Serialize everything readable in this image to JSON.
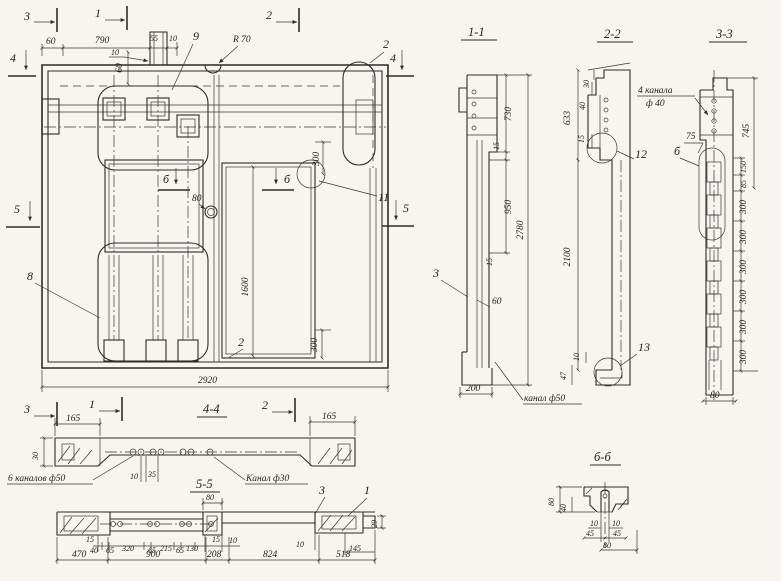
{
  "main": {
    "markers": {
      "top3": "3",
      "top1": "1",
      "top2": "2",
      "left4": "4",
      "right4": "4",
      "left5": "5",
      "right5": "5",
      "b": "б"
    },
    "dims": {
      "d60": "60",
      "d790": "790",
      "d55": "55",
      "d10": "10",
      "d10note": "10",
      "d60v": "60",
      "r70": "R 70",
      "d80": "80",
      "d300top": "300",
      "d300bot": "300",
      "d1600": "1600",
      "d2920": "2920"
    },
    "labels": {
      "l9": "9",
      "l2top": "2",
      "l11": "11",
      "l8": "8",
      "l2bot": "2"
    }
  },
  "section11": {
    "title": "1-1",
    "dims": {
      "d730": "730",
      "d15a": "15",
      "d950": "950",
      "d15b": "15",
      "d2780": "2780",
      "d60": "60",
      "d200": "200"
    },
    "label3": "3",
    "callout": "канал ф50"
  },
  "section22": {
    "title": "2-2",
    "dims": {
      "d633": "633",
      "d30": "30",
      "d40": "40",
      "d15": "15",
      "d2100": "2100",
      "d10": "10",
      "d47": "47"
    },
    "label12": "12",
    "label13": "13"
  },
  "section33": {
    "title": "3-3",
    "callout_line1": "4 канала",
    "callout_line2": "ф 40",
    "dims": {
      "d745": "745",
      "d75": "75",
      "d150": "150",
      "d85": "85",
      "d300": "300",
      "d80": "80"
    },
    "label_b": "б"
  },
  "view44": {
    "title": "4-4",
    "markers": {
      "m3": "3",
      "m1": "1",
      "m2": "2"
    },
    "dims": {
      "d165l": "165",
      "d165r": "165",
      "d30": "30",
      "d10": "10",
      "d35": "35"
    },
    "callout_left": "6 каналов ф50",
    "callout_right": "Канал ф30",
    "label3": "3",
    "label1": "1"
  },
  "view55": {
    "title": "5-5",
    "dims": {
      "d80": "80",
      "d15a": "15",
      "d40": "40",
      "d65": "65",
      "d320": "320",
      "d215": "215",
      "d130": "130",
      "d15b": "15",
      "d10a": "10",
      "d10b": "10",
      "d145": "145",
      "d29": "29",
      "d470": "470",
      "d900": "900",
      "d208": "208",
      "d824": "824",
      "d518": "518"
    }
  },
  "view66": {
    "title": "б-б",
    "dims": {
      "d80side": "80",
      "d40": "40",
      "d10": "10",
      "d45": "45",
      "d80bot": "80"
    }
  }
}
